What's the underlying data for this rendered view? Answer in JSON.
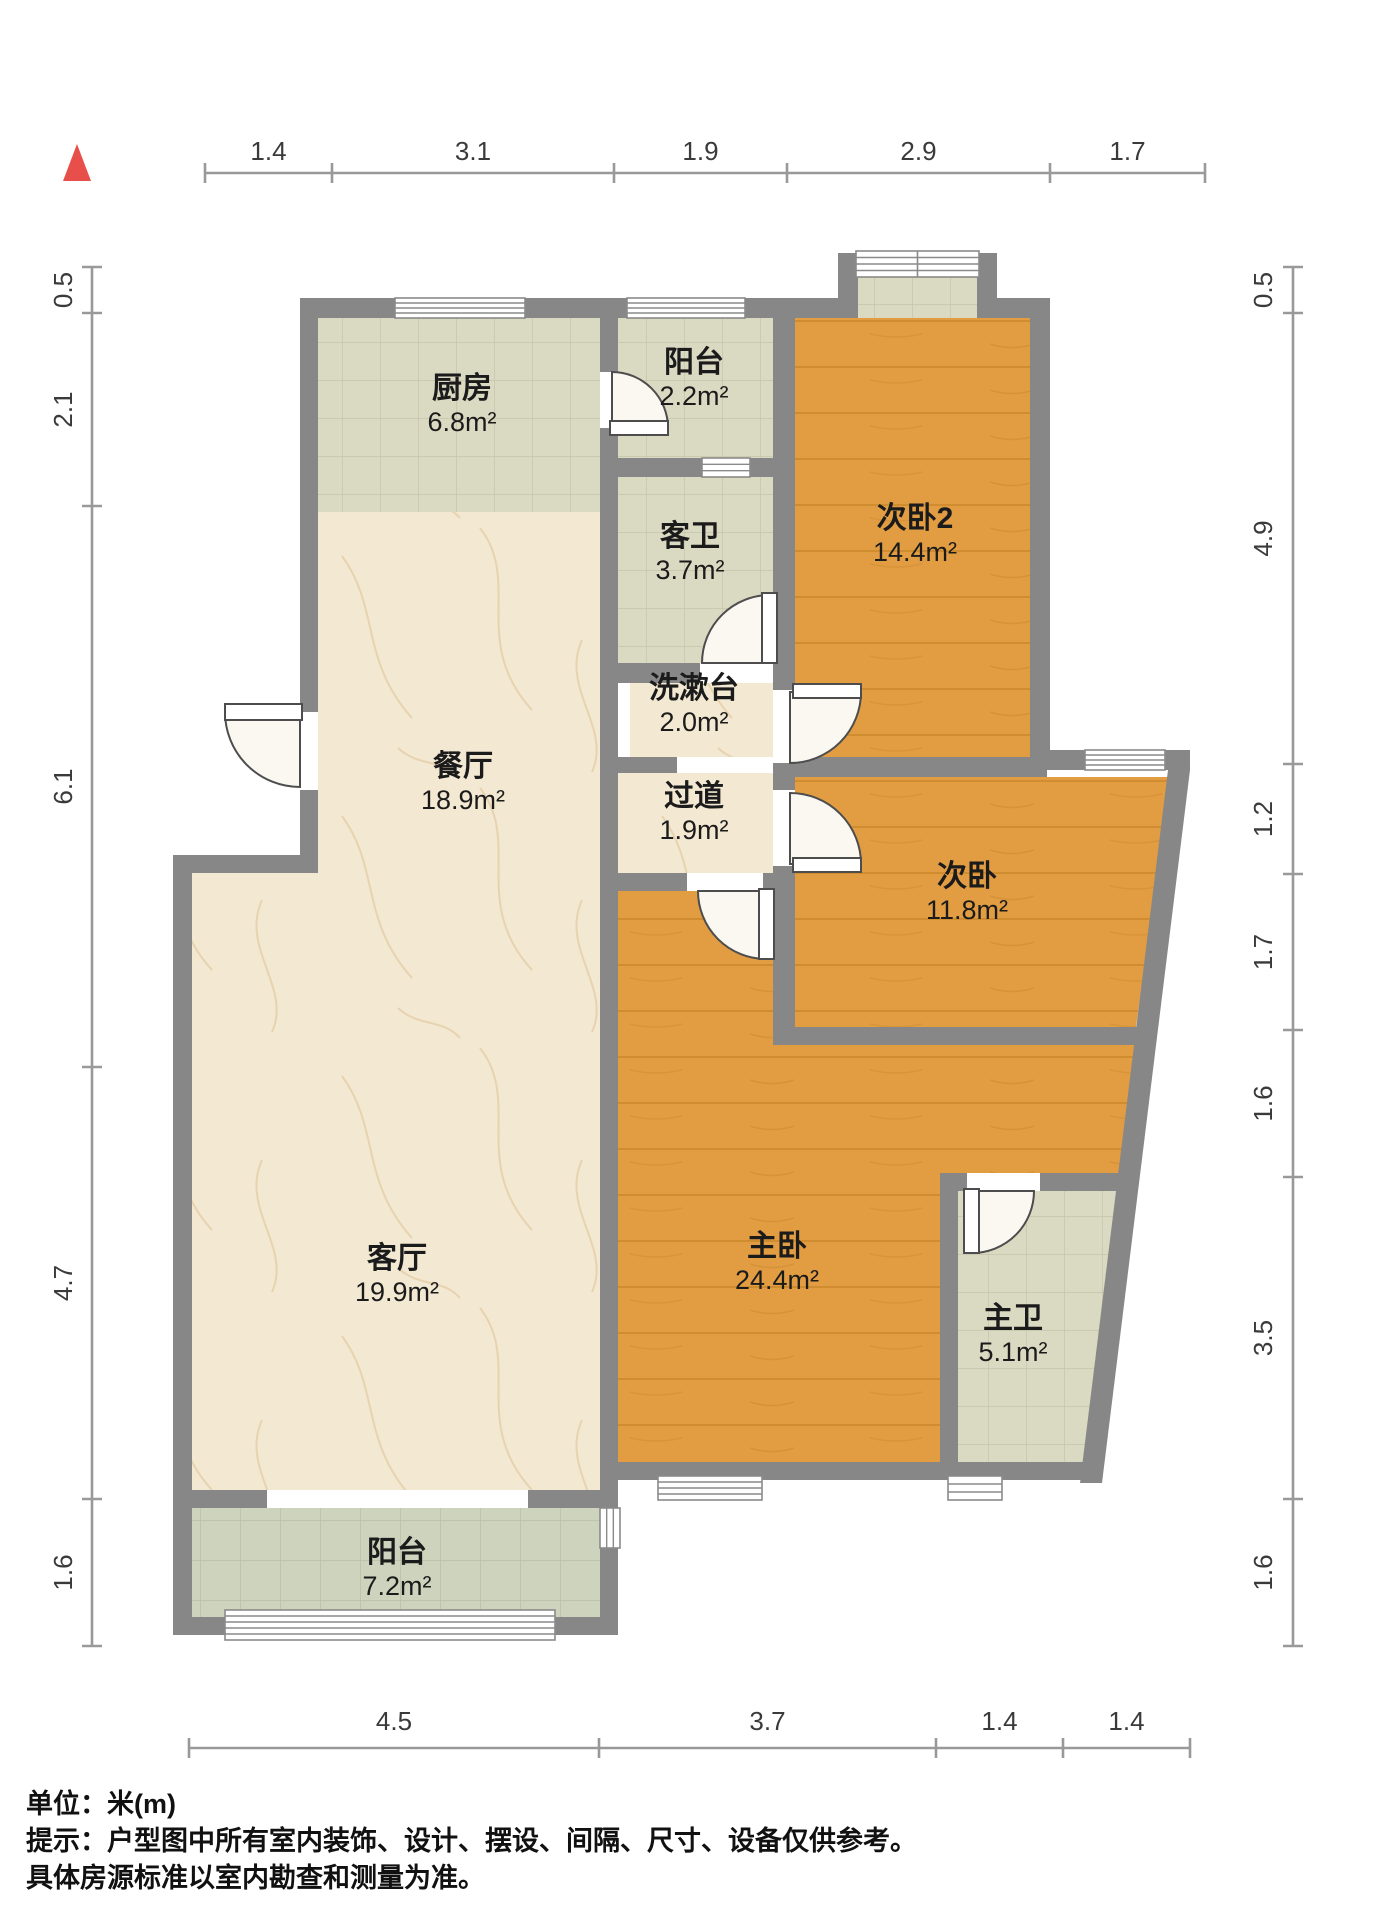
{
  "north_indicator": {
    "icon": "north-arrow",
    "color": "#e94f4a"
  },
  "rooms": [
    {
      "id": "kitchen",
      "name": "厨房",
      "area": "6.8m²",
      "floor": "tile",
      "label_x": 462,
      "label_y": 398
    },
    {
      "id": "balcony-top",
      "name": "阳台",
      "area": "2.2m²",
      "floor": "tile",
      "label_x": 694,
      "label_y": 372
    },
    {
      "id": "bedroom2-2",
      "name": "次卧2",
      "area": "14.4m²",
      "floor": "wood",
      "label_x": 915,
      "label_y": 528
    },
    {
      "id": "guest-bath",
      "name": "客卫",
      "area": "3.7m²",
      "floor": "tile",
      "label_x": 690,
      "label_y": 546
    },
    {
      "id": "washstand",
      "name": "洗漱台",
      "area": "2.0m²",
      "floor": "marble",
      "label_x": 694,
      "label_y": 698
    },
    {
      "id": "dining",
      "name": "餐厅",
      "area": "18.9m²",
      "floor": "marble",
      "label_x": 463,
      "label_y": 776
    },
    {
      "id": "hallway",
      "name": "过道",
      "area": "1.9m²",
      "floor": "marble",
      "label_x": 694,
      "label_y": 806
    },
    {
      "id": "bedroom2",
      "name": "次卧",
      "area": "11.8m²",
      "floor": "wood",
      "label_x": 967,
      "label_y": 886
    },
    {
      "id": "living",
      "name": "客厅",
      "area": "19.9m²",
      "floor": "marble",
      "label_x": 397,
      "label_y": 1268
    },
    {
      "id": "master",
      "name": "主卧",
      "area": "24.4m²",
      "floor": "wood",
      "label_x": 777,
      "label_y": 1256
    },
    {
      "id": "master-bath",
      "name": "主卫",
      "area": "5.1m²",
      "floor": "tile",
      "label_x": 1013,
      "label_y": 1328
    },
    {
      "id": "balcony-bottom",
      "name": "阳台",
      "area": "7.2m²",
      "floor": "tile2",
      "label_x": 397,
      "label_y": 1562
    }
  ],
  "dimensions": {
    "top": {
      "labels": [
        "1.4",
        "3.1",
        "1.9",
        "2.9",
        "1.7"
      ]
    },
    "bottom": {
      "labels": [
        "4.5",
        "3.7",
        "1.4",
        "1.4"
      ]
    },
    "left": {
      "labels": [
        "0.5",
        "2.1",
        "6.1",
        "4.7",
        "1.6"
      ]
    },
    "right": {
      "labels": [
        "0.5",
        "4.9",
        "1.2",
        "1.7",
        "1.6",
        "3.5",
        "1.6"
      ]
    }
  },
  "notes": [
    "单位：米(m)",
    "提示：户型图中所有室内装饰、设计、摆设、间隔、尺寸、设备仅供参考。",
    "具体房源标准以室内勘查和测量为准。"
  ],
  "colors": {
    "wall": "#878787",
    "wood": "#e29d43",
    "wood_line": "#c0801f",
    "tile": "#dad9c1",
    "tile_line": "#c6c5aa",
    "tile2": "#ced3bd",
    "tile2_line": "#b9bfa5",
    "marble": "#f3e8d2",
    "marble_vein": "#ddc194",
    "window_fill": "#ffffff",
    "frame": "#8a8a8a",
    "door": "#4d4d4d",
    "door_fill": "#faf8f1",
    "north": "#e94f4a",
    "dim_line": "#999999"
  }
}
